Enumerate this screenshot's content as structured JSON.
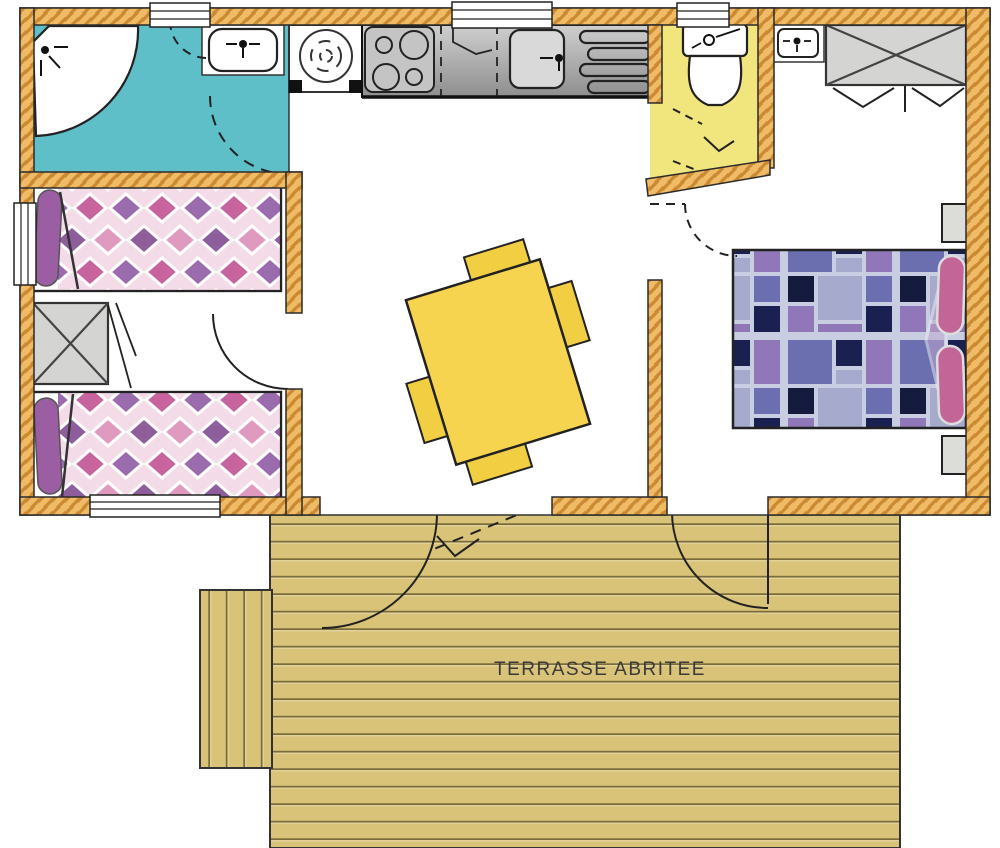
{
  "terrace": {
    "label": "TERRASSE ABRITEE"
  },
  "colors": {
    "wall_base": "#F0BB66",
    "wall_hatch": "#CB8A31",
    "outline": "#2B2B2B",
    "bath_floor": "#5FBFC9",
    "wc_floor": "#F1E57E",
    "terrace_base": "#D8C378",
    "terrace_line": "#7A6B3A",
    "table": "#F6D44F",
    "chair": "#F2CE42",
    "counter_light": "#CFCFCF",
    "counter_dark": "#8E8E8E",
    "stove": "#C4C4C4",
    "wardrobe": "#D4D4D2",
    "nightstand": "#DCDCD8",
    "twin_bg": "#F3DCE8",
    "twin_c1": "#C7639D",
    "twin_c2": "#9A6BAD",
    "twin_c3": "#E09ABF",
    "twin_c4": "#8E5E9C",
    "pillow_twin": "#9B5EA2",
    "double_gap": "#C9CDE1",
    "double_c1": "#6B6FB0",
    "double_c2": "#1A2150",
    "double_c3": "#8F77B8",
    "double_c4": "#A6ABCE",
    "double_c5": "#151B3D",
    "pillow_double": "#C46597",
    "duvet": "#BFA7CC",
    "label_color": "#3A3A3A"
  },
  "icons": {
    "shower_head": "dot-with-spray-lines",
    "faucet": "dot-with-cross-lines",
    "stove": "four-burner-circles",
    "water_heater": "circle-with-spiral",
    "wardrobe": "crossed-box",
    "window": "triple-line-band",
    "door_swing": "quarter-arc"
  }
}
